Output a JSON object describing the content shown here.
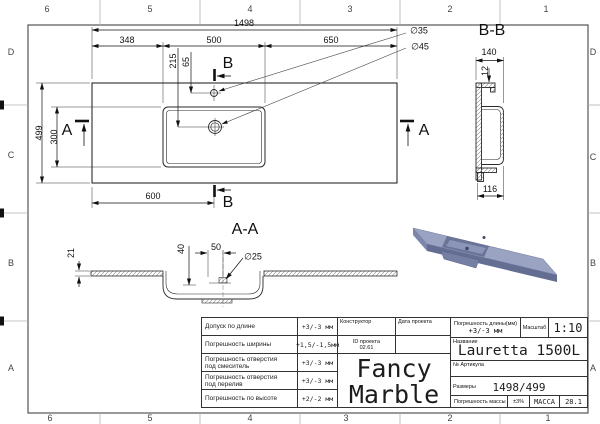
{
  "sheet": {
    "cols": [
      "6",
      "5",
      "4",
      "3",
      "2",
      "1"
    ],
    "rows": [
      "D",
      "C",
      "B",
      "A"
    ]
  },
  "plan_view": {
    "dim_total_length": "1498",
    "dim_left_offset": "348",
    "dim_basin_width": "500",
    "dim_right_offset": "650",
    "dim_total_depth": "499",
    "dim_basin_depth": "300",
    "dim_drain_from_left": "600",
    "dim_215": "215",
    "dim_65": "65",
    "dia_faucet": "∅35",
    "dia_drain": "∅45",
    "section_a": "A",
    "section_b": "B"
  },
  "section_bb": {
    "title": "B-B",
    "dim_width": "140",
    "dim_rim": "12",
    "dim_bottom": "116"
  },
  "section_aa": {
    "title": "A-A",
    "dim_thickness": "21",
    "dim_depth": "40",
    "dim_offset": "50",
    "dia_drain": "∅25"
  },
  "render_colors": {
    "top": "#9aa3c1",
    "front": "#646e92",
    "left": "#7d87ab",
    "end": "#8690b2",
    "recess": "#6a7499",
    "recess_floor": "#8b95b8",
    "underside": "#757fa3",
    "edge": "#5a6488",
    "hole": "#3f4966"
  },
  "title_block": {
    "tolerances": [
      {
        "label": "Допуск по длине",
        "label2": "",
        "value": "+3/-3 мм"
      },
      {
        "label": "Погрешность ширины",
        "label2": "",
        "value": "+1,5/-1,5мм"
      },
      {
        "label": "Погрешность отверстия",
        "label2": "под смеситель",
        "value": "+3/-3 мм"
      },
      {
        "label": "Погрешность отверстия",
        "label2": "под перелив",
        "value": "+3/-3 мм"
      },
      {
        "label": "Погрешность по высоте",
        "label2": "",
        "value": "+2/-2 мм"
      }
    ],
    "constructor_label": "Конструктор",
    "project_date_label": "Дата проекта",
    "project_id_label": "ID проекта",
    "project_id_value": "02.61",
    "brand_line1": "Fancy",
    "brand_line2": "Marble",
    "length_tol_label": "Погрешность длины(мм)",
    "length_tol_value": "+3/-3 мм",
    "scale_label": "Масштаб",
    "scale_value": "1:10",
    "name_label": "Название",
    "name_value": "Lauretta 1500L",
    "sku_label": "№ Артикула",
    "size_label": "Размеры",
    "size_value": "1498/499",
    "mass_tol_label": "Погрешность массы",
    "mass_tol_value": "±3%",
    "mass_label": "МАССА",
    "mass_value": "28.1"
  }
}
